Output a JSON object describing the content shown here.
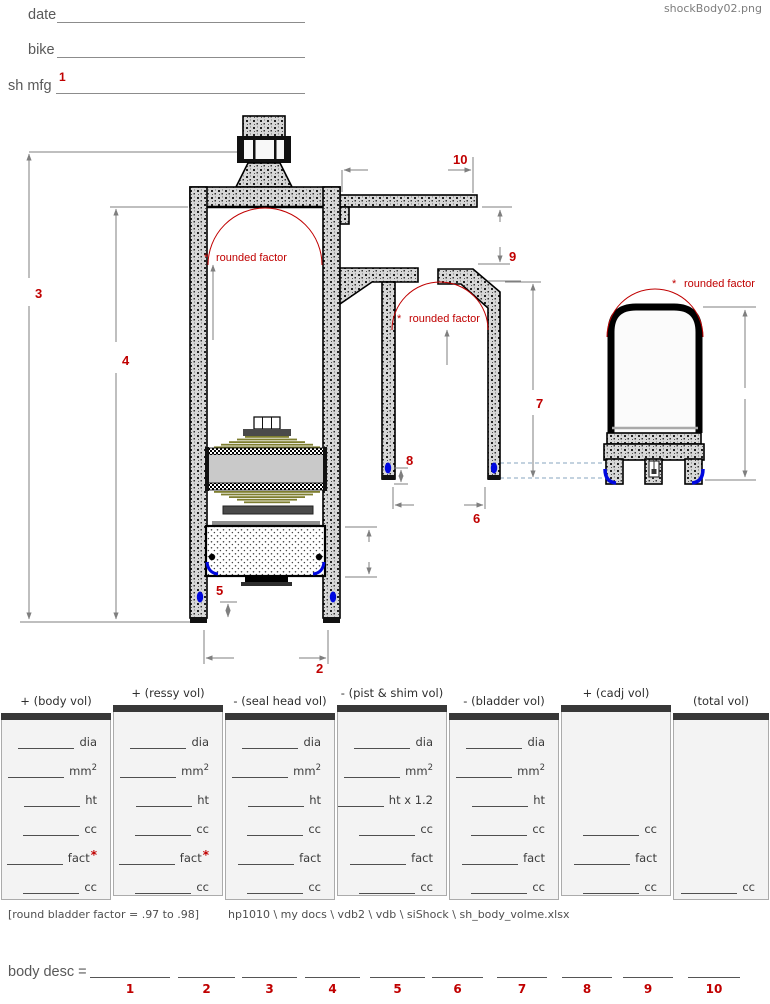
{
  "window": {
    "filename": "shockBody02.png"
  },
  "form": {
    "fields": [
      {
        "label": "date"
      },
      {
        "label": "bike"
      },
      {
        "label": "sh mfg",
        "ref": "1"
      }
    ]
  },
  "diagram": {
    "asterisk": "*",
    "rounded_factor": "rounded factor",
    "labels": {
      "d2": "2",
      "d3": "3",
      "d4": "4",
      "d5": "5",
      "d6": "6",
      "d7": "7",
      "d8": "8",
      "d9": "9",
      "d10": "10"
    }
  },
  "table": {
    "columns": [
      {
        "header": "+ (body vol)",
        "rows": [
          {
            "slot": 0,
            "label": "dia"
          },
          {
            "slot": 1,
            "label": "mm",
            "sup": "2"
          },
          {
            "slot": 2,
            "label": "ht"
          },
          {
            "slot": 3,
            "label": "cc"
          },
          {
            "slot": 4,
            "label": "fact",
            "mark": "*"
          },
          {
            "slot": 5,
            "label": "cc"
          }
        ]
      },
      {
        "header": "+ (ressy vol)",
        "rows": [
          {
            "slot": 0,
            "label": "dia"
          },
          {
            "slot": 1,
            "label": "mm",
            "sup": "2"
          },
          {
            "slot": 2,
            "label": "ht"
          },
          {
            "slot": 3,
            "label": "cc"
          },
          {
            "slot": 4,
            "label": "fact",
            "mark": "*"
          },
          {
            "slot": 5,
            "label": "cc"
          }
        ]
      },
      {
        "header": "- (seal head vol)",
        "rows": [
          {
            "slot": 0,
            "label": "dia"
          },
          {
            "slot": 1,
            "label": "mm",
            "sup": "2"
          },
          {
            "slot": 2,
            "label": "ht"
          },
          {
            "slot": 3,
            "label": "cc"
          },
          {
            "slot": 4,
            "label": "fact"
          },
          {
            "slot": 5,
            "label": "cc"
          }
        ]
      },
      {
        "header": "- (pist & shim vol)",
        "rows": [
          {
            "slot": 0,
            "label": "dia"
          },
          {
            "slot": 1,
            "label": "mm",
            "sup": "2"
          },
          {
            "slot": 2,
            "label": "ht x 1.2"
          },
          {
            "slot": 3,
            "label": "cc"
          },
          {
            "slot": 4,
            "label": "fact"
          },
          {
            "slot": 5,
            "label": "cc"
          }
        ]
      },
      {
        "header": "- (bladder vol)",
        "rows": [
          {
            "slot": 0,
            "label": "dia"
          },
          {
            "slot": 1,
            "label": "mm",
            "sup": "2"
          },
          {
            "slot": 2,
            "label": "ht"
          },
          {
            "slot": 3,
            "label": "cc"
          },
          {
            "slot": 4,
            "label": "fact"
          },
          {
            "slot": 5,
            "label": "cc"
          }
        ]
      },
      {
        "header": "+ (cadj vol)",
        "rows": [
          {
            "slot": 3,
            "label": "cc"
          },
          {
            "slot": 4,
            "label": "fact"
          },
          {
            "slot": 5,
            "label": "cc"
          }
        ]
      },
      {
        "header": "(total vol)",
        "rows": [
          {
            "slot": 5,
            "label": "cc"
          }
        ]
      }
    ]
  },
  "footer": {
    "note": "[round bladder factor = .97 to .98]",
    "path": "hp1010 \\ my docs \\ vdb2 \\ vdb \\ siShock \\ sh_body_volme.xlsx"
  },
  "body_desc": {
    "label": "body desc =",
    "slots": [
      "1",
      "2",
      "3",
      "4",
      "5",
      "6",
      "7",
      "8",
      "9",
      "10"
    ]
  }
}
